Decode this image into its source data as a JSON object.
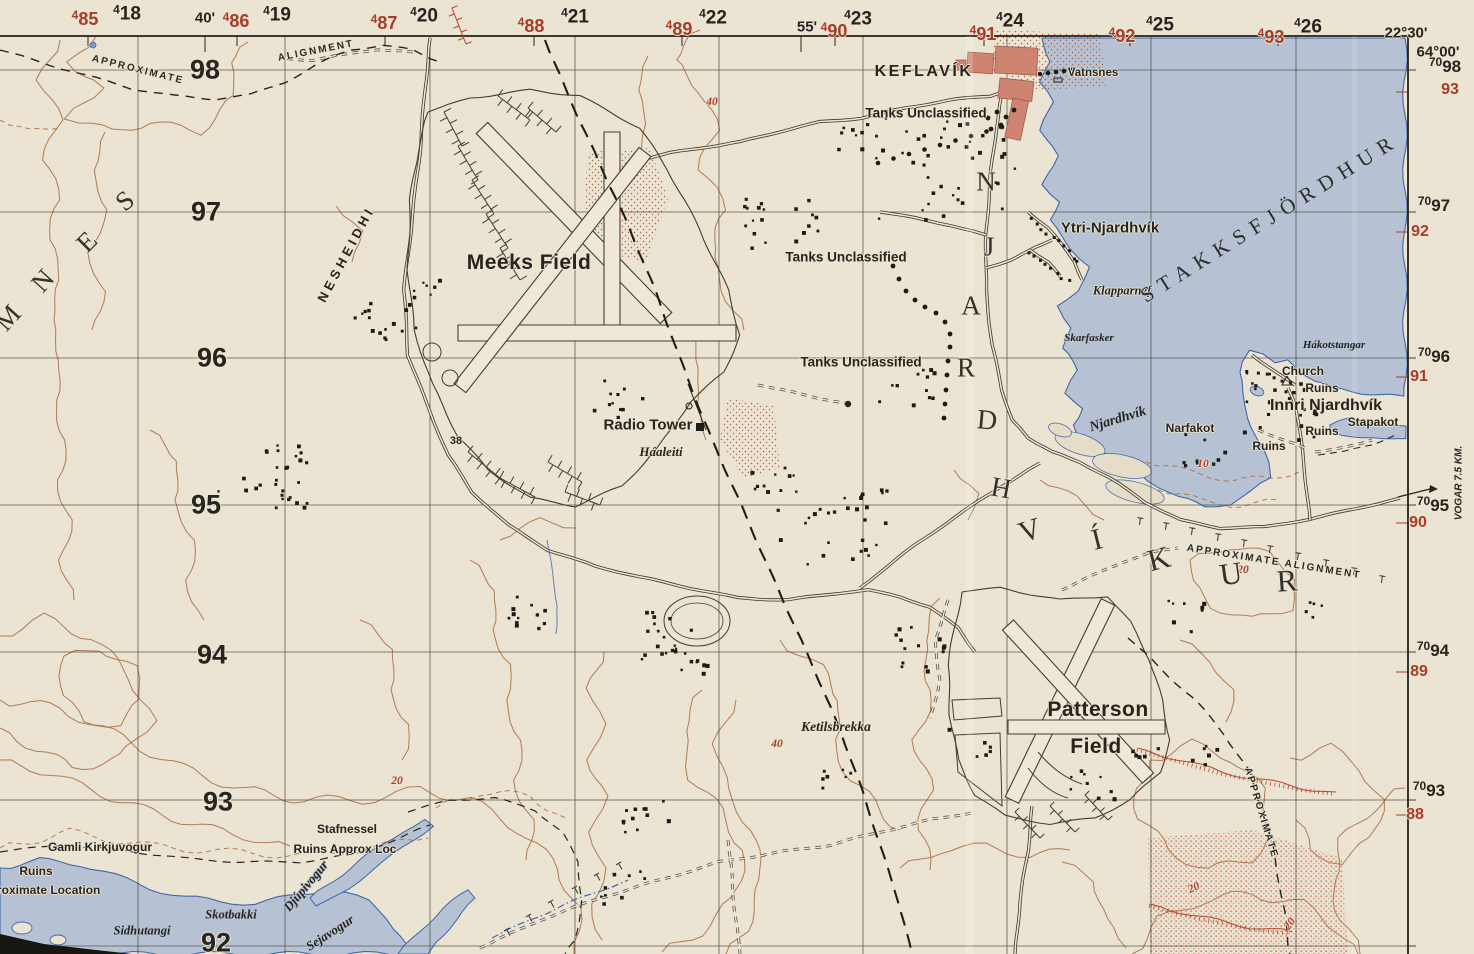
{
  "title": "Topographic map sheet — Keflavík / Meeks Field / Patterson Field, Njardhvíkur, Iceland",
  "colors": {
    "paper": "#ece4d2",
    "water": "#b6c2d4",
    "coast": "#4066a8",
    "contour": "#a86f45",
    "red_print": "#a8402a",
    "ink": "#26241f",
    "town_fill": "#cf8472",
    "road": "#3a382f",
    "grid": "#45433a"
  },
  "margin": {
    "top_black": [
      {
        "sup": "4",
        "num": "18",
        "x": 127,
        "y": 14
      },
      {
        "sup": "4",
        "num": "19",
        "x": 277,
        "y": 15
      },
      {
        "sup": "4",
        "num": "20",
        "x": 424,
        "y": 16
      },
      {
        "sup": "4",
        "num": "21",
        "x": 575,
        "y": 17
      },
      {
        "sup": "4",
        "num": "22",
        "x": 713,
        "y": 18
      },
      {
        "sup": "4",
        "num": "23",
        "x": 858,
        "y": 19
      },
      {
        "sup": "4",
        "num": "24",
        "x": 1010,
        "y": 21
      },
      {
        "sup": "4",
        "num": "25",
        "x": 1160,
        "y": 25
      },
      {
        "sup": "4",
        "num": "26",
        "x": 1308,
        "y": 27
      }
    ],
    "top_red": [
      {
        "sup": "4",
        "num": "85",
        "x": 85,
        "y": 19
      },
      {
        "sup": "4",
        "num": "86",
        "x": 236,
        "y": 21
      },
      {
        "sup": "4",
        "num": "87",
        "x": 384,
        "y": 23
      },
      {
        "sup": "4",
        "num": "88",
        "x": 531,
        "y": 26
      },
      {
        "sup": "4",
        "num": "89",
        "x": 679,
        "y": 29
      },
      {
        "sup": "4",
        "num": "90",
        "x": 834,
        "y": 31
      },
      {
        "sup": "4",
        "num": "91",
        "x": 983,
        "y": 34
      },
      {
        "sup": "4",
        "num": "92",
        "x": 1122,
        "y": 36
      },
      {
        "sup": "4",
        "num": "93",
        "x": 1271,
        "y": 37
      }
    ],
    "top_minutes": [
      {
        "text": "40'",
        "x": 205,
        "y": 18
      },
      {
        "text": "55'",
        "x": 807,
        "y": 27
      },
      {
        "text": "22°30'",
        "x": 1406,
        "y": 33
      }
    ],
    "corner_lat": {
      "text": "64°00'",
      "x": 1438,
      "y": 52
    },
    "right_black": [
      {
        "sup": "70",
        "num": "98",
        "x": 1445,
        "y": 66
      },
      {
        "sup": "70",
        "num": "97",
        "x": 1434,
        "y": 205
      },
      {
        "sup": "70",
        "num": "96",
        "x": 1434,
        "y": 356
      },
      {
        "sup": "70",
        "num": "95",
        "x": 1433,
        "y": 505
      },
      {
        "sup": "70",
        "num": "94",
        "x": 1433,
        "y": 650
      },
      {
        "sup": "70",
        "num": "93",
        "x": 1429,
        "y": 790
      }
    ],
    "right_red": [
      {
        "num": "93",
        "x": 1450,
        "y": 90
      },
      {
        "num": "92",
        "x": 1420,
        "y": 232
      },
      {
        "num": "91",
        "x": 1419,
        "y": 377
      },
      {
        "num": "90",
        "x": 1418,
        "y": 523
      },
      {
        "num": "89",
        "x": 1419,
        "y": 672
      },
      {
        "num": "88",
        "x": 1415,
        "y": 815
      }
    ],
    "left_gridnums": [
      {
        "num": "98",
        "x": 205,
        "y": 70
      },
      {
        "num": "97",
        "x": 206,
        "y": 212
      },
      {
        "num": "96",
        "x": 212,
        "y": 358
      },
      {
        "num": "95",
        "x": 206,
        "y": 505
      },
      {
        "num": "94",
        "x": 212,
        "y": 655
      },
      {
        "num": "93",
        "x": 218,
        "y": 802
      },
      {
        "num": "92",
        "x": 216,
        "y": 943
      }
    ],
    "vogar": {
      "text": "VOGAR 7.5 KM.",
      "x": 1459,
      "y": 483,
      "rot": -90
    }
  },
  "labels": [
    {
      "text": "APPROXIMATE",
      "x": 138,
      "y": 70,
      "cls": "align",
      "rot": 14
    },
    {
      "text": "ALIGNMENT",
      "x": 316,
      "y": 51,
      "cls": "align",
      "rot": -11
    },
    {
      "text": "KEFLAVÍK",
      "x": 924,
      "y": 72,
      "cls": "townCaps"
    },
    {
      "text": "Vatnsnes",
      "x": 1093,
      "y": 73,
      "cls": "place",
      "sz": 11.5
    },
    {
      "text": "Tanks Unclassified",
      "x": 926,
      "y": 113,
      "cls": "place"
    },
    {
      "text": "Tanks Unclassified",
      "x": 846,
      "y": 257,
      "cls": "place"
    },
    {
      "text": "Tanks Unclassified",
      "x": 861,
      "y": 362,
      "cls": "place"
    },
    {
      "text": "Meeks Field",
      "x": 529,
      "y": 263,
      "cls": "plac eLg"
    },
    {
      "text": "NESHEIDHI",
      "x": 346,
      "y": 254,
      "cls": "spread",
      "rot": -62
    },
    {
      "text": "Radio Tower",
      "x": 648,
      "y": 425,
      "cls": "placeMd"
    },
    {
      "text": "Háaleiti",
      "x": 661,
      "y": 452,
      "cls": "it",
      "sz": 13
    },
    {
      "text": "Ytri-Njardhvík",
      "x": 1110,
      "y": 228,
      "cls": "placeMd"
    },
    {
      "text": "Klapparnef",
      "x": 1122,
      "y": 291,
      "cls": "it"
    },
    {
      "text": "Skarfasker",
      "x": 1089,
      "y": 338,
      "cls": "itSm",
      "onwater": true
    },
    {
      "text": "STAKKSFJÖRDHUR",
      "x": 1270,
      "y": 218,
      "cls": "fjord",
      "rot": -32,
      "onwater": true
    },
    {
      "text": "Hákotstangar",
      "x": 1334,
      "y": 345,
      "cls": "itSm",
      "onwater": true
    },
    {
      "text": "Njardhvík",
      "x": 1118,
      "y": 420,
      "cls": "it",
      "sz": 14,
      "rot": -17,
      "onwater": true
    },
    {
      "text": "Church",
      "x": 1303,
      "y": 371,
      "cls": "place",
      "sz": 12
    },
    {
      "text": "Ruins",
      "x": 1322,
      "y": 388,
      "cls": "place",
      "sz": 12
    },
    {
      "text": "Innri Njardhvík",
      "x": 1326,
      "y": 406,
      "cls": "placeMd",
      "sz": 16
    },
    {
      "text": "Narfakot",
      "x": 1190,
      "y": 428,
      "cls": "place",
      "sz": 12
    },
    {
      "text": "Ruins",
      "x": 1322,
      "y": 431,
      "cls": "place",
      "sz": 12
    },
    {
      "text": "Stapakot",
      "x": 1373,
      "y": 422,
      "cls": "place",
      "sz": 12
    },
    {
      "text": "Ruins",
      "x": 1269,
      "y": 446,
      "cls": "place",
      "sz": 12
    },
    {
      "text": "APPROXIMATE ALIGNMENT",
      "x": 1274,
      "y": 562,
      "cls": "align",
      "rot": 9
    },
    {
      "text": "Patterson",
      "x": 1098,
      "y": 710,
      "cls": "placeLg"
    },
    {
      "text": "Field",
      "x": 1096,
      "y": 747,
      "cls": "placeLg"
    },
    {
      "text": "Ketilsbrekka",
      "x": 836,
      "y": 727,
      "cls": "it",
      "sz": 13.5
    },
    {
      "text": "APPROXIMATE",
      "x": 1261,
      "y": 813,
      "cls": "align",
      "rot": 73
    },
    {
      "text": "Gamli Kirkjuvogur",
      "x": 100,
      "y": 847,
      "cls": "place",
      "sz": 12
    },
    {
      "text": "Ruins",
      "x": 36,
      "y": 871,
      "cls": "place",
      "sz": 12
    },
    {
      "text": "roximate Location",
      "x": -3,
      "y": 890,
      "cls": "place",
      "sz": 12,
      "anchor": "left"
    },
    {
      "text": "Sidhutangi",
      "x": 142,
      "y": 931,
      "cls": "it",
      "sz": 12.5,
      "onwater": true
    },
    {
      "text": "Skotbakki",
      "x": 231,
      "y": 915,
      "cls": "it",
      "sz": 12.5,
      "onwater": true
    },
    {
      "text": "Djúpivogur",
      "x": 306,
      "y": 886,
      "cls": "it",
      "sz": 13,
      "rot": -50,
      "onwater": true
    },
    {
      "text": "Sejavogur",
      "x": 330,
      "y": 933,
      "cls": "it",
      "sz": 13,
      "rot": -33,
      "onwater": true
    },
    {
      "text": "Stafnessel",
      "x": 347,
      "y": 829,
      "cls": "place",
      "sz": 12
    },
    {
      "text": "Ruins Approx Loc",
      "x": 345,
      "y": 849,
      "cls": "place",
      "sz": 12
    },
    {
      "text": "38",
      "x": 456,
      "y": 441,
      "cls": "place",
      "sz": 11
    },
    {
      "text": "40",
      "x": 712,
      "y": 102,
      "cls": "red"
    },
    {
      "text": "40",
      "x": 777,
      "y": 744,
      "cls": "red"
    },
    {
      "text": "20",
      "x": 397,
      "y": 781,
      "cls": "red"
    },
    {
      "text": "20",
      "x": 1243,
      "y": 570,
      "cls": "red"
    },
    {
      "text": "10",
      "x": 1203,
      "y": 464,
      "cls": "red"
    },
    {
      "text": "20",
      "x": 1194,
      "y": 888,
      "cls": "red",
      "rot": -25
    },
    {
      "text": "20",
      "x": 1290,
      "y": 924,
      "cls": "red",
      "rot": -55
    }
  ],
  "letterings": [
    {
      "text": "M",
      "x": 8,
      "y": 318,
      "rot": -48,
      "sz": 27
    },
    {
      "text": "N",
      "x": 43,
      "y": 281,
      "rot": -48,
      "sz": 27
    },
    {
      "text": "E",
      "x": 87,
      "y": 242,
      "rot": -45,
      "sz": 27
    },
    {
      "text": "S",
      "x": 125,
      "y": 201,
      "rot": -40,
      "sz": 27
    },
    {
      "text": "N",
      "x": 986,
      "y": 182,
      "rot": 0,
      "sz": 27
    },
    {
      "text": "J",
      "x": 989,
      "y": 247,
      "rot": 0,
      "sz": 27
    },
    {
      "text": "A",
      "x": 971,
      "y": 306,
      "rot": 0,
      "sz": 27
    },
    {
      "text": "R",
      "x": 966,
      "y": 368,
      "rot": 0,
      "sz": 27
    },
    {
      "text": "D",
      "x": 987,
      "y": 421,
      "rot": 5,
      "sz": 28
    },
    {
      "text": "H",
      "x": 1001,
      "y": 489,
      "rot": 10,
      "sz": 28
    },
    {
      "text": "V",
      "x": 1030,
      "y": 531,
      "rot": -18,
      "sz": 30
    },
    {
      "text": "Í",
      "x": 1097,
      "y": 540,
      "rot": -14,
      "sz": 30
    },
    {
      "text": "K",
      "x": 1159,
      "y": 559,
      "rot": -14,
      "sz": 31
    },
    {
      "text": "U",
      "x": 1231,
      "y": 574,
      "rot": -8,
      "sz": 31
    },
    {
      "text": "R",
      "x": 1287,
      "y": 581,
      "rot": -4,
      "sz": 31
    }
  ],
  "features": {
    "building_clusters": [
      {
        "x": 385,
        "y": 318,
        "r": 34,
        "n": 16
      },
      {
        "x": 262,
        "y": 478,
        "r": 48,
        "n": 26
      },
      {
        "x": 425,
        "y": 292,
        "r": 16,
        "n": 7
      },
      {
        "x": 948,
        "y": 168,
        "r": 72,
        "n": 40
      },
      {
        "x": 782,
        "y": 220,
        "r": 40,
        "n": 20
      },
      {
        "x": 862,
        "y": 140,
        "r": 28,
        "n": 10
      },
      {
        "x": 1282,
        "y": 408,
        "r": 48,
        "n": 26
      },
      {
        "x": 1205,
        "y": 452,
        "r": 24,
        "n": 9
      },
      {
        "x": 618,
        "y": 400,
        "r": 26,
        "n": 11
      },
      {
        "x": 832,
        "y": 525,
        "r": 55,
        "n": 30
      },
      {
        "x": 662,
        "y": 630,
        "r": 40,
        "n": 18
      },
      {
        "x": 536,
        "y": 614,
        "r": 28,
        "n": 12
      },
      {
        "x": 930,
        "y": 650,
        "r": 34,
        "n": 14
      },
      {
        "x": 648,
        "y": 812,
        "r": 30,
        "n": 12
      },
      {
        "x": 836,
        "y": 778,
        "r": 18,
        "n": 7
      },
      {
        "x": 620,
        "y": 890,
        "r": 26,
        "n": 10
      },
      {
        "x": 1208,
        "y": 756,
        "r": 16,
        "n": 6
      },
      {
        "x": 1186,
        "y": 616,
        "r": 22,
        "n": 8
      },
      {
        "x": 1145,
        "y": 758,
        "r": 14,
        "n": 5
      },
      {
        "x": 908,
        "y": 390,
        "r": 30,
        "n": 12
      },
      {
        "x": 772,
        "y": 480,
        "r": 25,
        "n": 10
      },
      {
        "x": 700,
        "y": 660,
        "r": 20,
        "n": 8
      },
      {
        "x": 298,
        "y": 508,
        "r": 10,
        "n": 3
      },
      {
        "x": 1312,
        "y": 608,
        "r": 14,
        "n": 5
      },
      {
        "x": 1090,
        "y": 790,
        "r": 26,
        "n": 9
      },
      {
        "x": 965,
        "y": 745,
        "r": 26,
        "n": 6
      }
    ],
    "building_rows": [
      {
        "x1": 1032,
        "y1": 218,
        "x2": 1078,
        "y2": 262,
        "n": 10
      },
      {
        "x1": 1030,
        "y1": 252,
        "x2": 1068,
        "y2": 282,
        "n": 8
      },
      {
        "x1": 1248,
        "y1": 370,
        "x2": 1292,
        "y2": 382,
        "n": 6
      }
    ],
    "tank_dots": {
      "rows": [
        {
          "x1": 878,
          "y1": 163,
          "x2": 1002,
          "y2": 127,
          "n": 9
        },
        {
          "x1": 1040,
          "y1": 74,
          "x2": 1072,
          "y2": 70,
          "n": 5
        }
      ],
      "points": [
        [
          893,
          266
        ],
        [
          899,
          279
        ],
        [
          906,
          291
        ],
        [
          915,
          300
        ],
        [
          925,
          307
        ],
        [
          936,
          313
        ],
        [
          945,
          322
        ],
        [
          950,
          334
        ],
        [
          950,
          347
        ],
        [
          948,
          361
        ],
        [
          947,
          375
        ],
        [
          946,
          390
        ],
        [
          945,
          404
        ],
        [
          944,
          418
        ],
        [
          988,
          118
        ],
        [
          997,
          112
        ],
        [
          1006,
          117
        ],
        [
          1014,
          110
        ],
        [
          991,
          129
        ],
        [
          1001,
          125
        ]
      ]
    }
  }
}
